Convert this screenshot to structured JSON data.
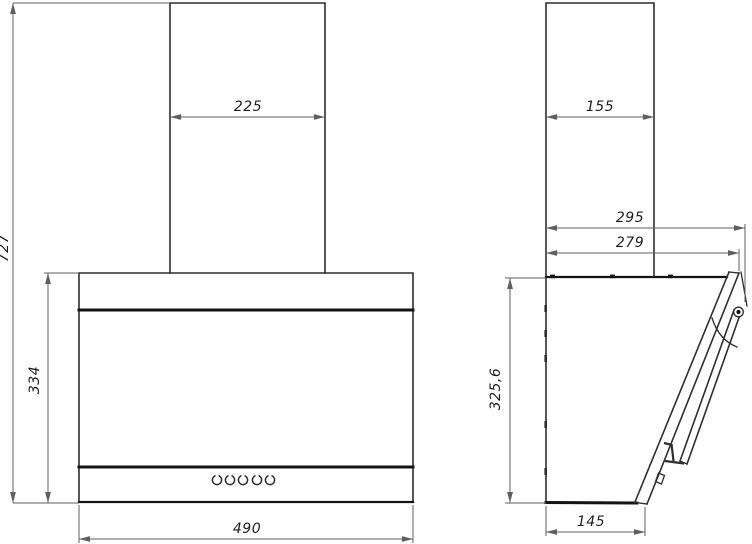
{
  "drawing": {
    "views": [
      "front",
      "side"
    ],
    "subject": "kitchen-hood-dimension-drawing"
  },
  "dimensions": {
    "front_overall_height": "727",
    "front_chimney_width": "225",
    "front_body_height": "334",
    "front_body_width": "490",
    "side_chimney_depth": "155",
    "side_overall_depth": "295",
    "side_upper_depth": "279",
    "side_body_height": "325,6",
    "side_bottom_depth": "145"
  },
  "controls": {
    "button_count": 5
  },
  "colors": {
    "background": "#ffffff",
    "outline": "#2e2e2e",
    "thick_line": "#141414",
    "dimension_line": "#5f5f5f",
    "text": "#1e1e1e"
  }
}
